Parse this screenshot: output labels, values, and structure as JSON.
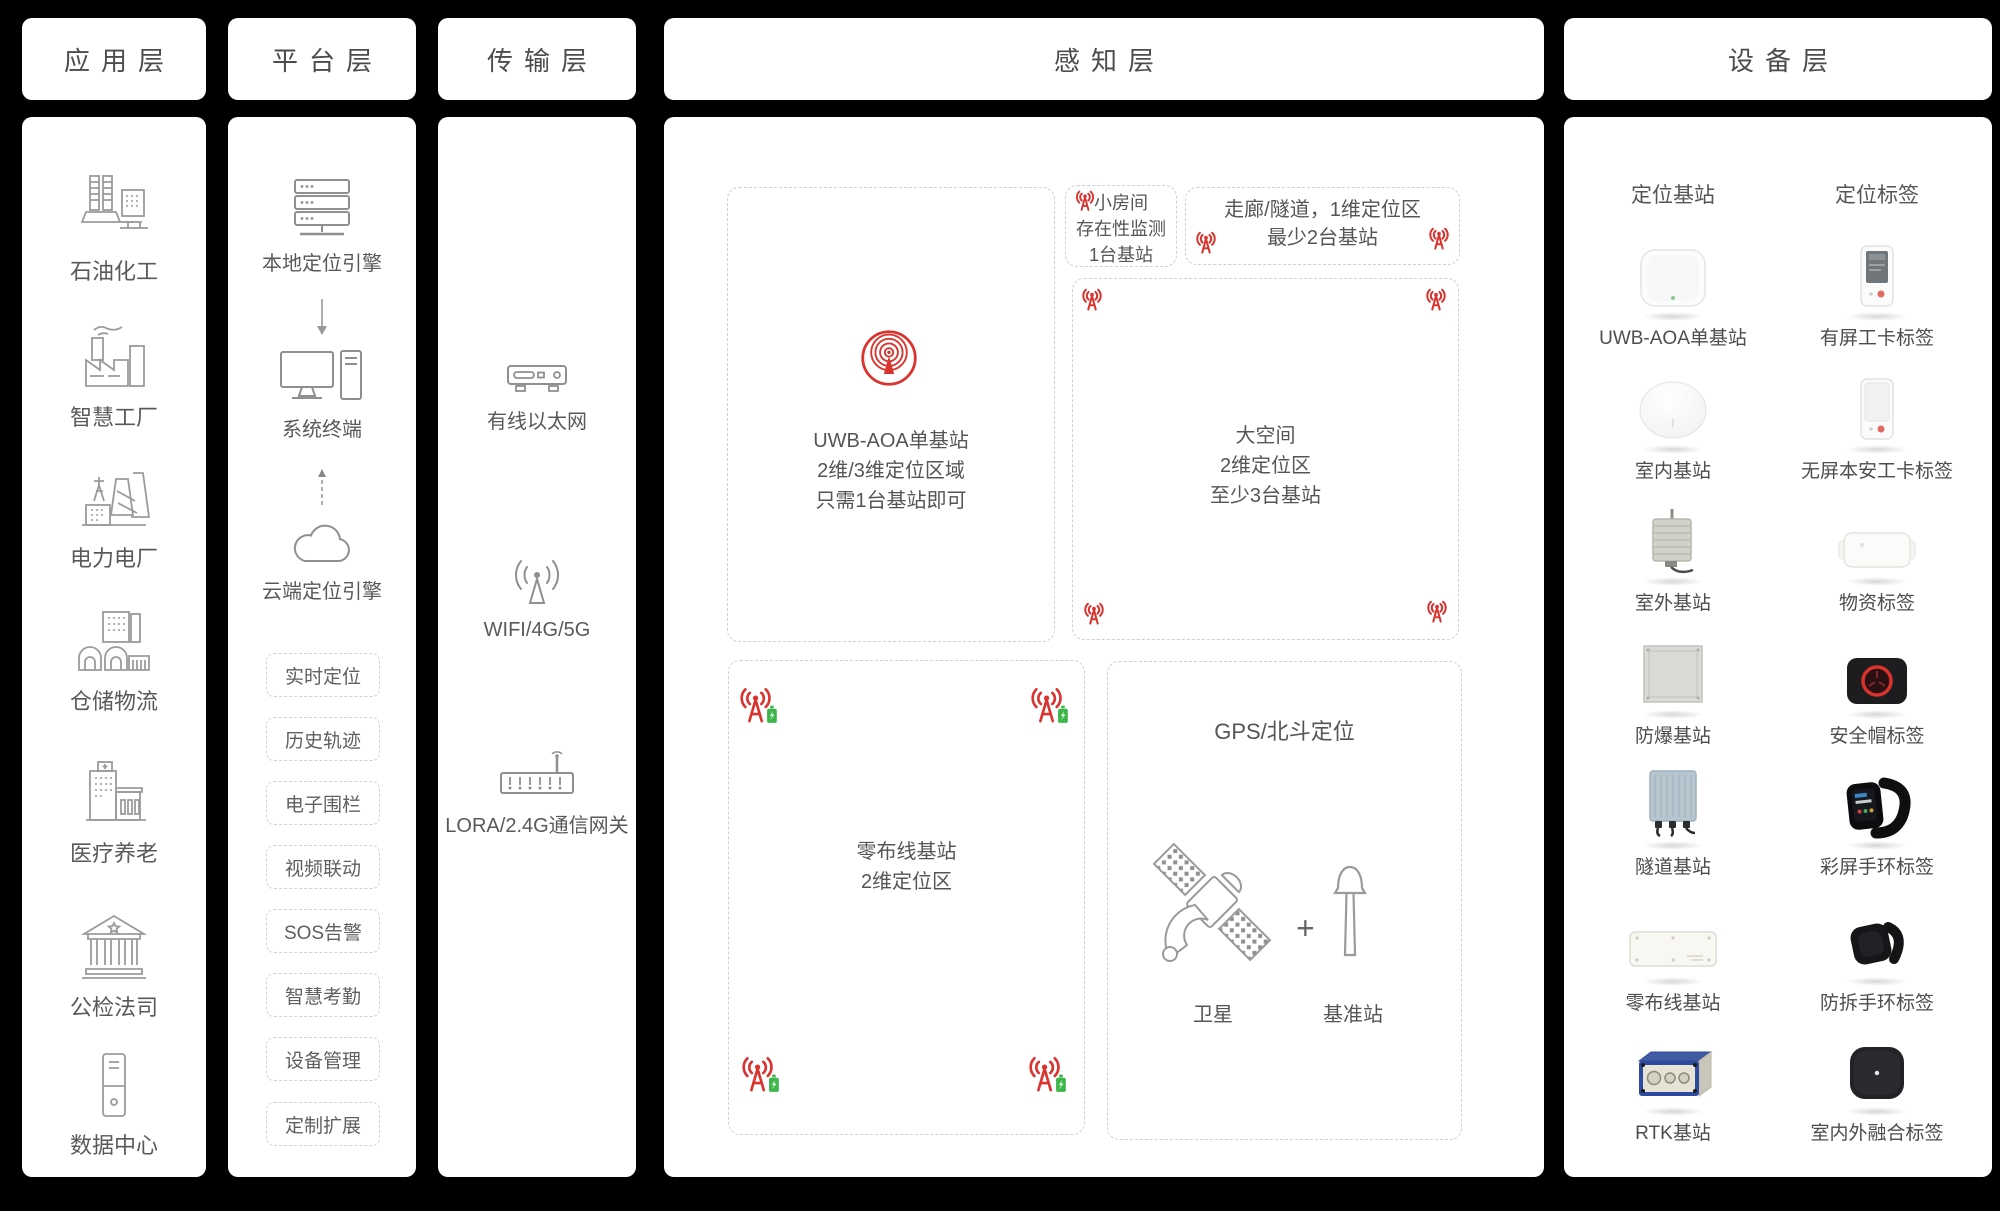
{
  "colors": {
    "background": "#000000",
    "panel": "#ffffff",
    "text": "#595959",
    "dashed_border": "#cfcfcf",
    "accent_red": "#d9342f",
    "battery_green": "#3db54a"
  },
  "app_layer": {
    "title": "应用层",
    "items": [
      {
        "label": "石油化工",
        "icon": "oil-refinery-icon"
      },
      {
        "label": "智慧工厂",
        "icon": "smart-factory-icon"
      },
      {
        "label": "电力电厂",
        "icon": "power-plant-icon"
      },
      {
        "label": "仓储物流",
        "icon": "warehouse-logistics-icon"
      },
      {
        "label": "医疗养老",
        "icon": "hospital-icon"
      },
      {
        "label": "公检法司",
        "icon": "courthouse-icon"
      },
      {
        "label": "数据中心",
        "icon": "data-center-icon"
      }
    ]
  },
  "platform_layer": {
    "title": "平台层",
    "nodes": [
      {
        "label": "本地定位引擎",
        "icon": "server-stack-icon"
      },
      {
        "label": "系统终端",
        "icon": "desktop-terminal-icon"
      },
      {
        "label": "云端定位引擎",
        "icon": "cloud-icon"
      }
    ],
    "features": [
      {
        "label": "实时定位"
      },
      {
        "label": "历史轨迹"
      },
      {
        "label": "电子围栏"
      },
      {
        "label": "视频联动"
      },
      {
        "label": "SOS告警"
      },
      {
        "label": "智慧考勤"
      },
      {
        "label": "设备管理"
      },
      {
        "label": "定制扩展"
      }
    ]
  },
  "transport_layer": {
    "title": "传输层",
    "items": [
      {
        "label": "有线以太网",
        "icon": "ethernet-device-icon"
      },
      {
        "label": "WIFI/4G/5G",
        "icon": "wireless-antenna-icon"
      },
      {
        "label": "LORA/2.4G通信网关",
        "icon": "lora-gateway-icon"
      }
    ]
  },
  "perception_layer": {
    "title": "感知层",
    "uwb_zone": {
      "line1": "UWB-AOA单基站",
      "line2": "2维/3维定位区域",
      "line3": "只需1台基站即可"
    },
    "small_room_zone": {
      "line1": "小房间",
      "line2": "存在性监测",
      "line3": "1台基站"
    },
    "corridor_zone": {
      "line1": "走廊/隧道，1维定位区",
      "line2": "最少2台基站"
    },
    "large_space_zone": {
      "line1": "大空间",
      "line2": "2维定位区",
      "line3": "至少3台基站"
    },
    "zero_wiring_zone": {
      "line1": "零布线基站",
      "line2": "2维定位区"
    },
    "gnss_zone": {
      "title": "GPS/北斗定位",
      "satellite_label": "卫星",
      "plus_sign": "+",
      "base_station_label": "基准站"
    }
  },
  "device_layer": {
    "title": "设备层",
    "column_headers": {
      "stations": "定位基站",
      "tags": "定位标签"
    },
    "rows": [
      {
        "station": "UWB-AOA单基站",
        "tag": "有屏工卡标签"
      },
      {
        "station": "室内基站",
        "tag": "无屏本安工卡标签"
      },
      {
        "station": "室外基站",
        "tag": "物资标签"
      },
      {
        "station": "防爆基站",
        "tag": "安全帽标签"
      },
      {
        "station": "隧道基站",
        "tag": "彩屏手环标签"
      },
      {
        "station": "零布线基站",
        "tag": "防拆手环标签"
      },
      {
        "station": "RTK基站",
        "tag": "室内外融合标签"
      }
    ]
  }
}
